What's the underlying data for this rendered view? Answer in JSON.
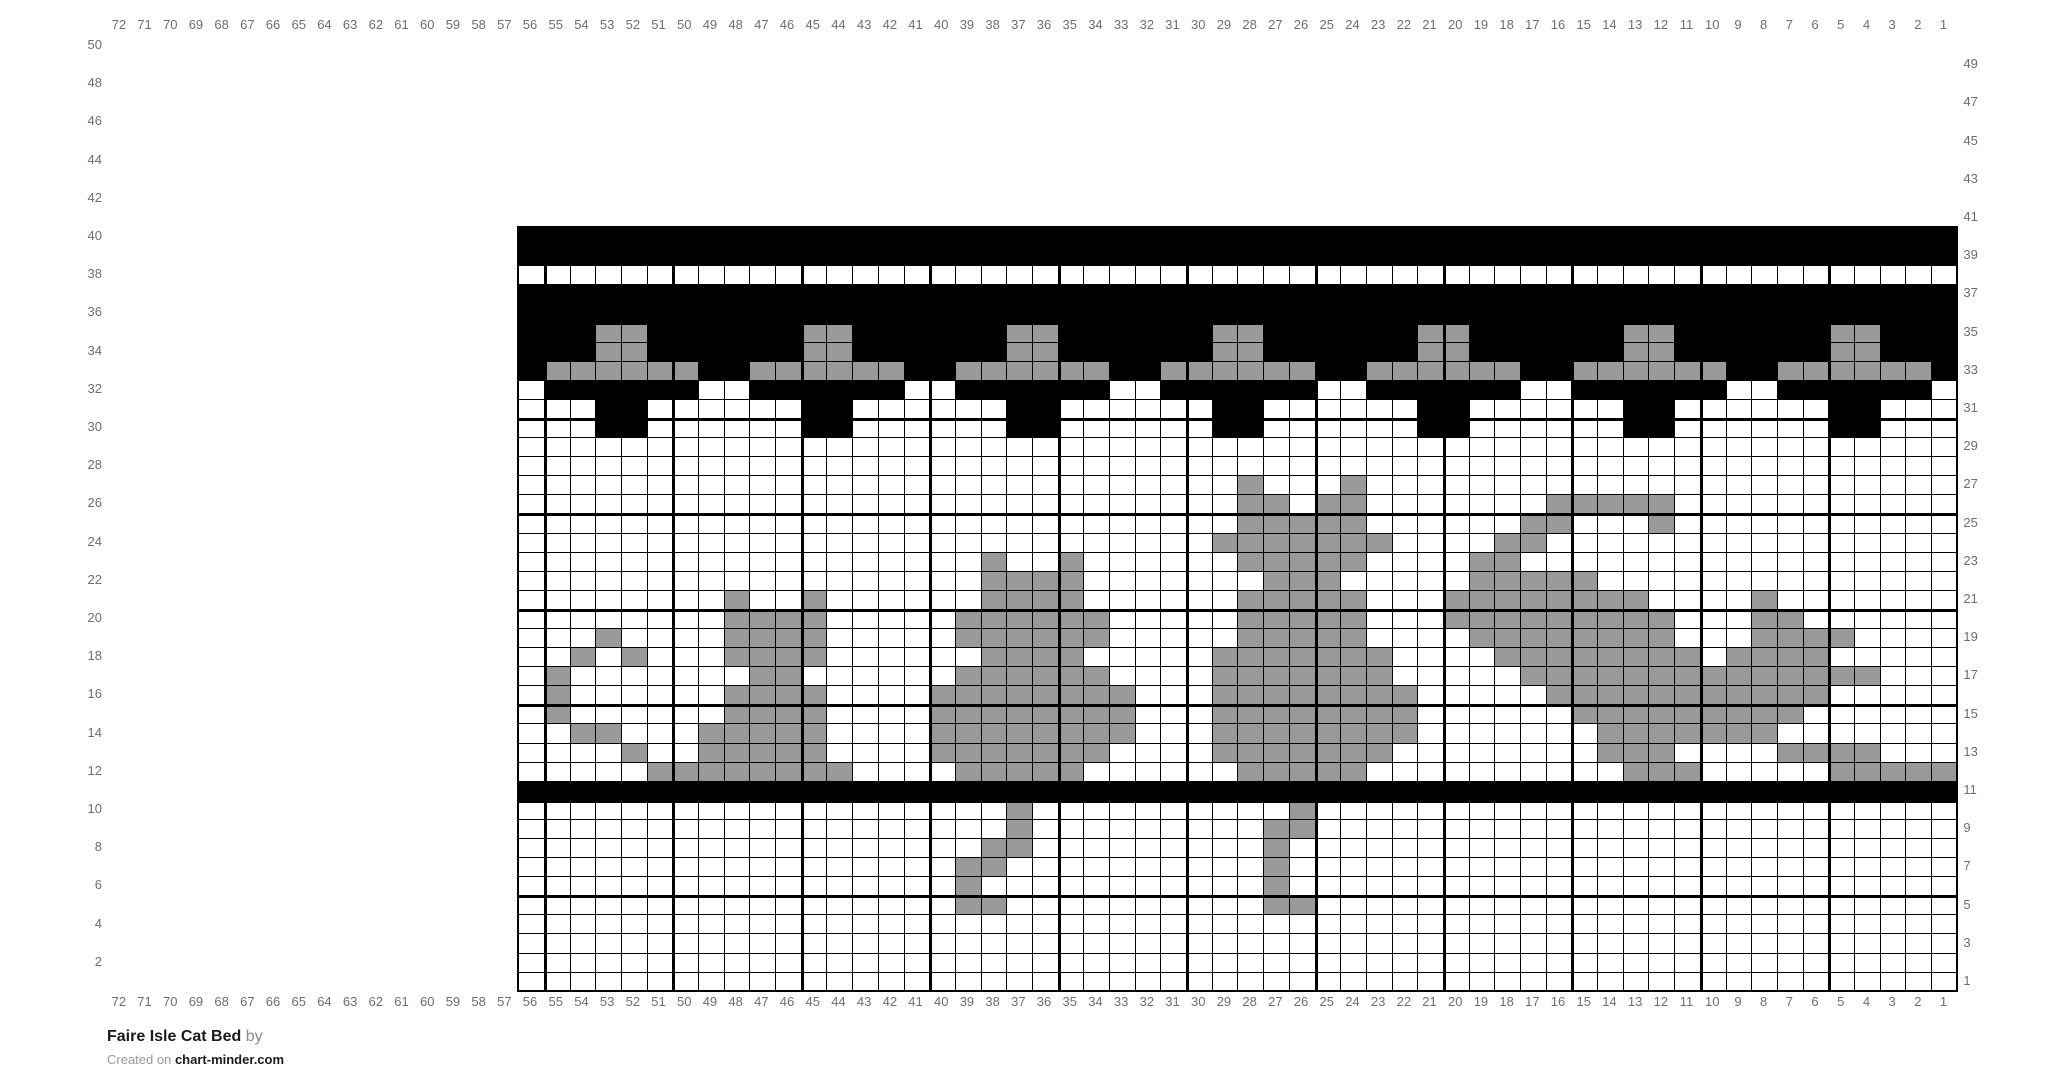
{
  "title": {
    "name": "Faire Isle Cat Bed",
    "by_suffix": "by",
    "credit_prefix": "Created on",
    "credit_site": "chart-minder.com"
  },
  "labels": {
    "top": [
      "72",
      "71",
      "70",
      "69",
      "68",
      "67",
      "66",
      "65",
      "64",
      "63",
      "62",
      "61",
      "60",
      "59",
      "58",
      "57",
      "56",
      "55",
      "54",
      "53",
      "52",
      "51",
      "50",
      "49",
      "48",
      "47",
      "46",
      "45",
      "44",
      "43",
      "42",
      "41",
      "40",
      "39",
      "38",
      "37",
      "36",
      "35",
      "34",
      "33",
      "32",
      "31",
      "30",
      "29",
      "28",
      "27",
      "26",
      "25",
      "24",
      "23",
      "22",
      "21",
      "20",
      "19",
      "18",
      "17",
      "16",
      "15",
      "14",
      "13",
      "12",
      "11",
      "10",
      "9",
      "8",
      "7",
      "6",
      "5",
      "4",
      "3",
      "2",
      "1"
    ],
    "bottom": [
      "72",
      "71",
      "70",
      "69",
      "68",
      "67",
      "66",
      "65",
      "64",
      "63",
      "62",
      "61",
      "60",
      "59",
      "58",
      "57",
      "56",
      "55",
      "54",
      "53",
      "52",
      "51",
      "50",
      "49",
      "48",
      "47",
      "46",
      "45",
      "44",
      "43",
      "42",
      "41",
      "40",
      "39",
      "38",
      "37",
      "36",
      "35",
      "34",
      "33",
      "32",
      "31",
      "30",
      "29",
      "28",
      "27",
      "26",
      "25",
      "24",
      "23",
      "22",
      "21",
      "20",
      "19",
      "18",
      "17",
      "16",
      "15",
      "14",
      "13",
      "12",
      "11",
      "10",
      "9",
      "8",
      "7",
      "6",
      "5",
      "4",
      "3",
      "2",
      "1"
    ],
    "left": [
      "50",
      "48",
      "46",
      "44",
      "42",
      "40",
      "38",
      "36",
      "34",
      "32",
      "30",
      "28",
      "26",
      "24",
      "22",
      "20",
      "18",
      "16",
      "14",
      "12",
      "10",
      "8",
      "6",
      "4",
      "2"
    ],
    "right": [
      "49",
      "47",
      "45",
      "43",
      "41",
      "39",
      "37",
      "35",
      "33",
      "31",
      "29",
      "27",
      "25",
      "23",
      "21",
      "19",
      "17",
      "15",
      "13",
      "11",
      "9",
      "7",
      "5",
      "3",
      "1"
    ]
  },
  "grid": {
    "cols": 56,
    "rows": 40,
    "top_row_number": 40,
    "left_col_number": 56,
    "cell_colors": {
      ".": "#ffffff",
      "g": "#999999",
      "b": "#000000"
    },
    "rows_top_to_bottom": [
      "bbbbbbbbbbbbbbbbbbbbbbbbbbbbbbbbbbbbbbbbbbbbbbbbbbbbbbbb",
      "bbbbbbbbbbbbbbbbbbbbbbbbbbbbbbbbbbbbbbbbbbbbbbbbbbbbbbbb",
      "........................................................",
      "bbbbbbbbbbbbbbbbbbbbbbbbbbbbbbbbbbbbbbbbbbbbbbbbbbbbbbbb",
      "bbbbbbbbbbbbbbbbbbbbbbbbbbbbbbbbbbbbbbbbbbbbbbbbbbbbbbbb",
      "bbbggbbbbbbggbbbbbbggbbbbbbggbbbbbbggbbbbbbggbbbbbbggbbb",
      "bbbggbbbbbbggbbbbbbggbbbbbbggbbbbbbggbbbbbbggbbbbbbggbbb",
      "bggggggbbggggggbbggggggbbggggggbbggggggbbggggggbbggggggb",
      ".bbbbbb..bbbbbb..bbbbbb..bbbbbb..bbbbbb..bbbbbb..bbbbbb.",
      "...bb......bb......bb......bb......bb......bb......bb...",
      "...bb......bb......bb......bb......bb......bb......bb...",
      "........................................................",
      "........................................................",
      "............................g...g.......................",
      "............................gg.gg.......ggggg...........",
      "............................ggggg......gg...g...........",
      "...........................ggggggg....gg................",
      "..................g..g......ggggg....gg.................",
      "..................gggg.......ggg.....ggggg..............",
      "........g..g......gggg......ggggg...gggggggg....g.......",
      "........gggg.....gggggg.....ggggg...ggggggggg...gg......",
      "...g....gggg.....gggggg.....ggggg....gggggggg...gggg....",
      "..g.g...gggg......gggg.....ggggggg....gggggggg.gggg.....",
      ".g.......gg......gggggg....ggggggg.....gggggggggggggg...",
      ".g......gggg....gggggggg...gggggggg.....ggggggggggg.....",
      ".g......gggg....gggggggg...gggggggg......ggggggggg......",
      "..gg...ggggg....gggggggg...gggggggg.......ggggggg.......",
      "....g..ggggg....ggggggg....ggggggg........ggg....gggg...",
      ".....gggggggg....ggggg......ggggg..........ggg.....ggggg",
      "bbbbbbbbbbbbbbbbbbbbbbbbbbbbbbbbbbbbbbbbbbbbbbbbbbbbbbbb",
      "...................g..........g.........................",
      "...................g.........gg.........................",
      "..................gg.........g..........................",
      ".................gg..........g..........................",
      ".................g...........g..........................",
      ".................gg..........gg.........................",
      "........................................................",
      "........................................................",
      "........................................................",
      "........................................................"
    ]
  }
}
